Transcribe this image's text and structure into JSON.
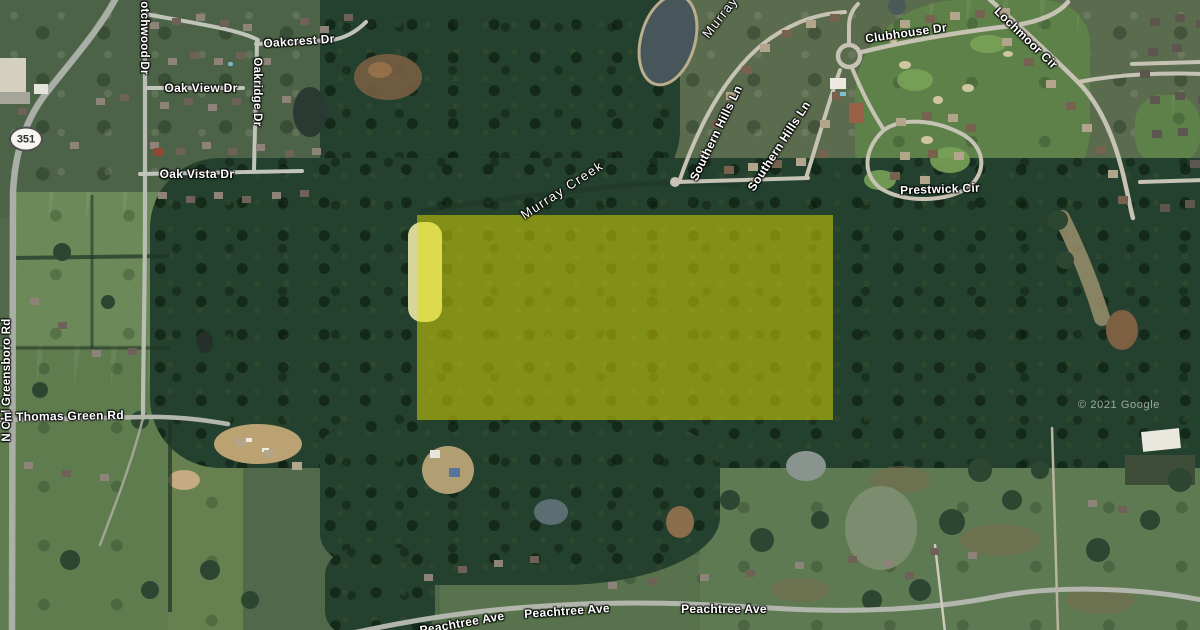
{
  "map": {
    "view_type": "satellite",
    "attribution": "© 2021 Google",
    "route_shield": "351",
    "highlight_parcel": {
      "fill": "#e2e000",
      "opacity": 0.5
    },
    "label_color": "#ffffff",
    "labels": {
      "scotchwood_dr": "otchwood Dr",
      "oakcrest_dr": "Oakcrest Dr",
      "oak_view_dr": "Oak View Dr",
      "oakridge_dr": "Oakridge Dr",
      "oak_vista_dr": "Oak Vista Dr",
      "n_old_greensboro_rd": "N Old Greensboro Rd",
      "e_thomas_green_rd": "E Thomas Green Rd",
      "peachtree_ave": "Peachtree Ave",
      "southern_hills_ln": "Southern Hills Ln",
      "clubhouse_dr": "Clubhouse Dr",
      "lochmoor_cir": "Lochmoor Cir",
      "prestwick_cir": "Prestwick Cir"
    },
    "water_labels": {
      "murray": "Murray",
      "murray_creek": "Murray Creek"
    }
  }
}
